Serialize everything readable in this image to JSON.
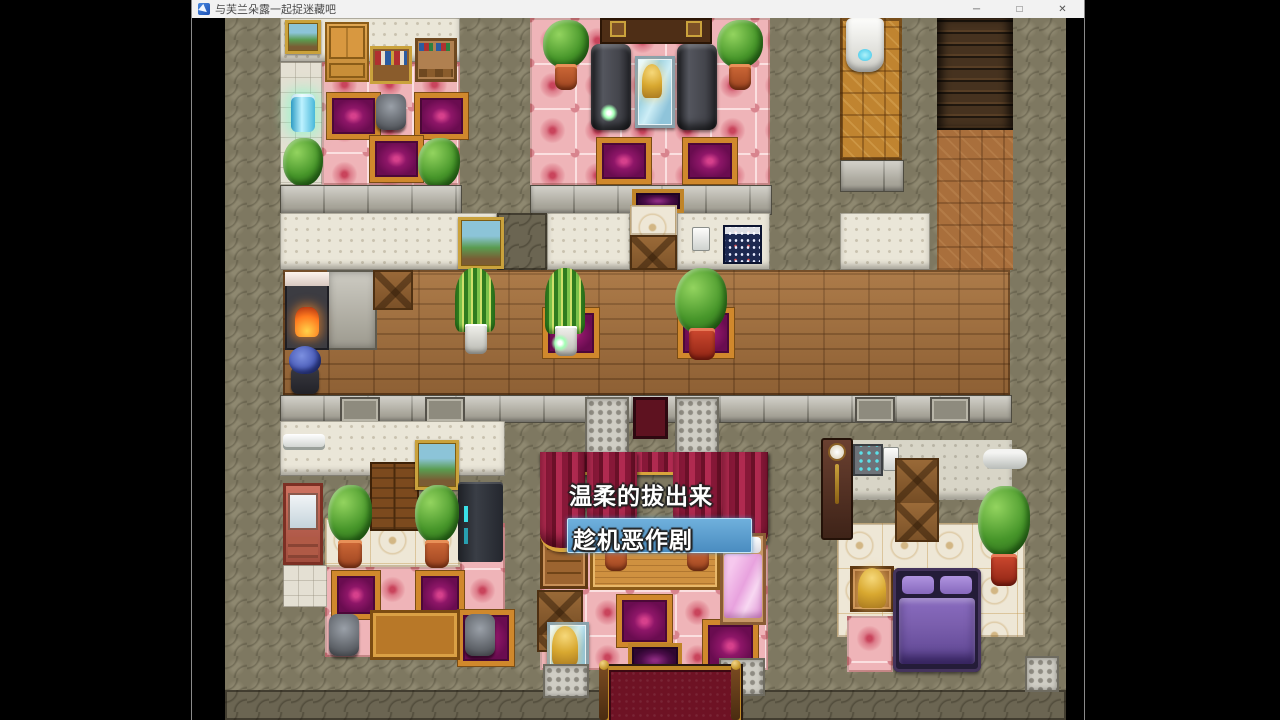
{
  "window": {
    "title": "与芙兰朵露一起捉迷藏吧",
    "controls": {
      "minimize": "─",
      "maximize": "□",
      "close": "✕"
    }
  },
  "game": {
    "dialogue_choices": [
      {
        "label": "温柔的拔出来",
        "selected": false
      },
      {
        "label": "趁机恶作剧",
        "selected": true
      }
    ]
  },
  "theme": {
    "titlebar-bg": "#f2f2f2",
    "titlebar-text": "#4a4a4a",
    "choice-highlight": "#6fb0dc",
    "stone": "#7e7861",
    "wood": "#9e6b3a",
    "pink-tile": "#efb4b8",
    "rug-purple": "#8e1668",
    "rug-border": "#d0882c",
    "bed-purple": "#7b5fae"
  }
}
